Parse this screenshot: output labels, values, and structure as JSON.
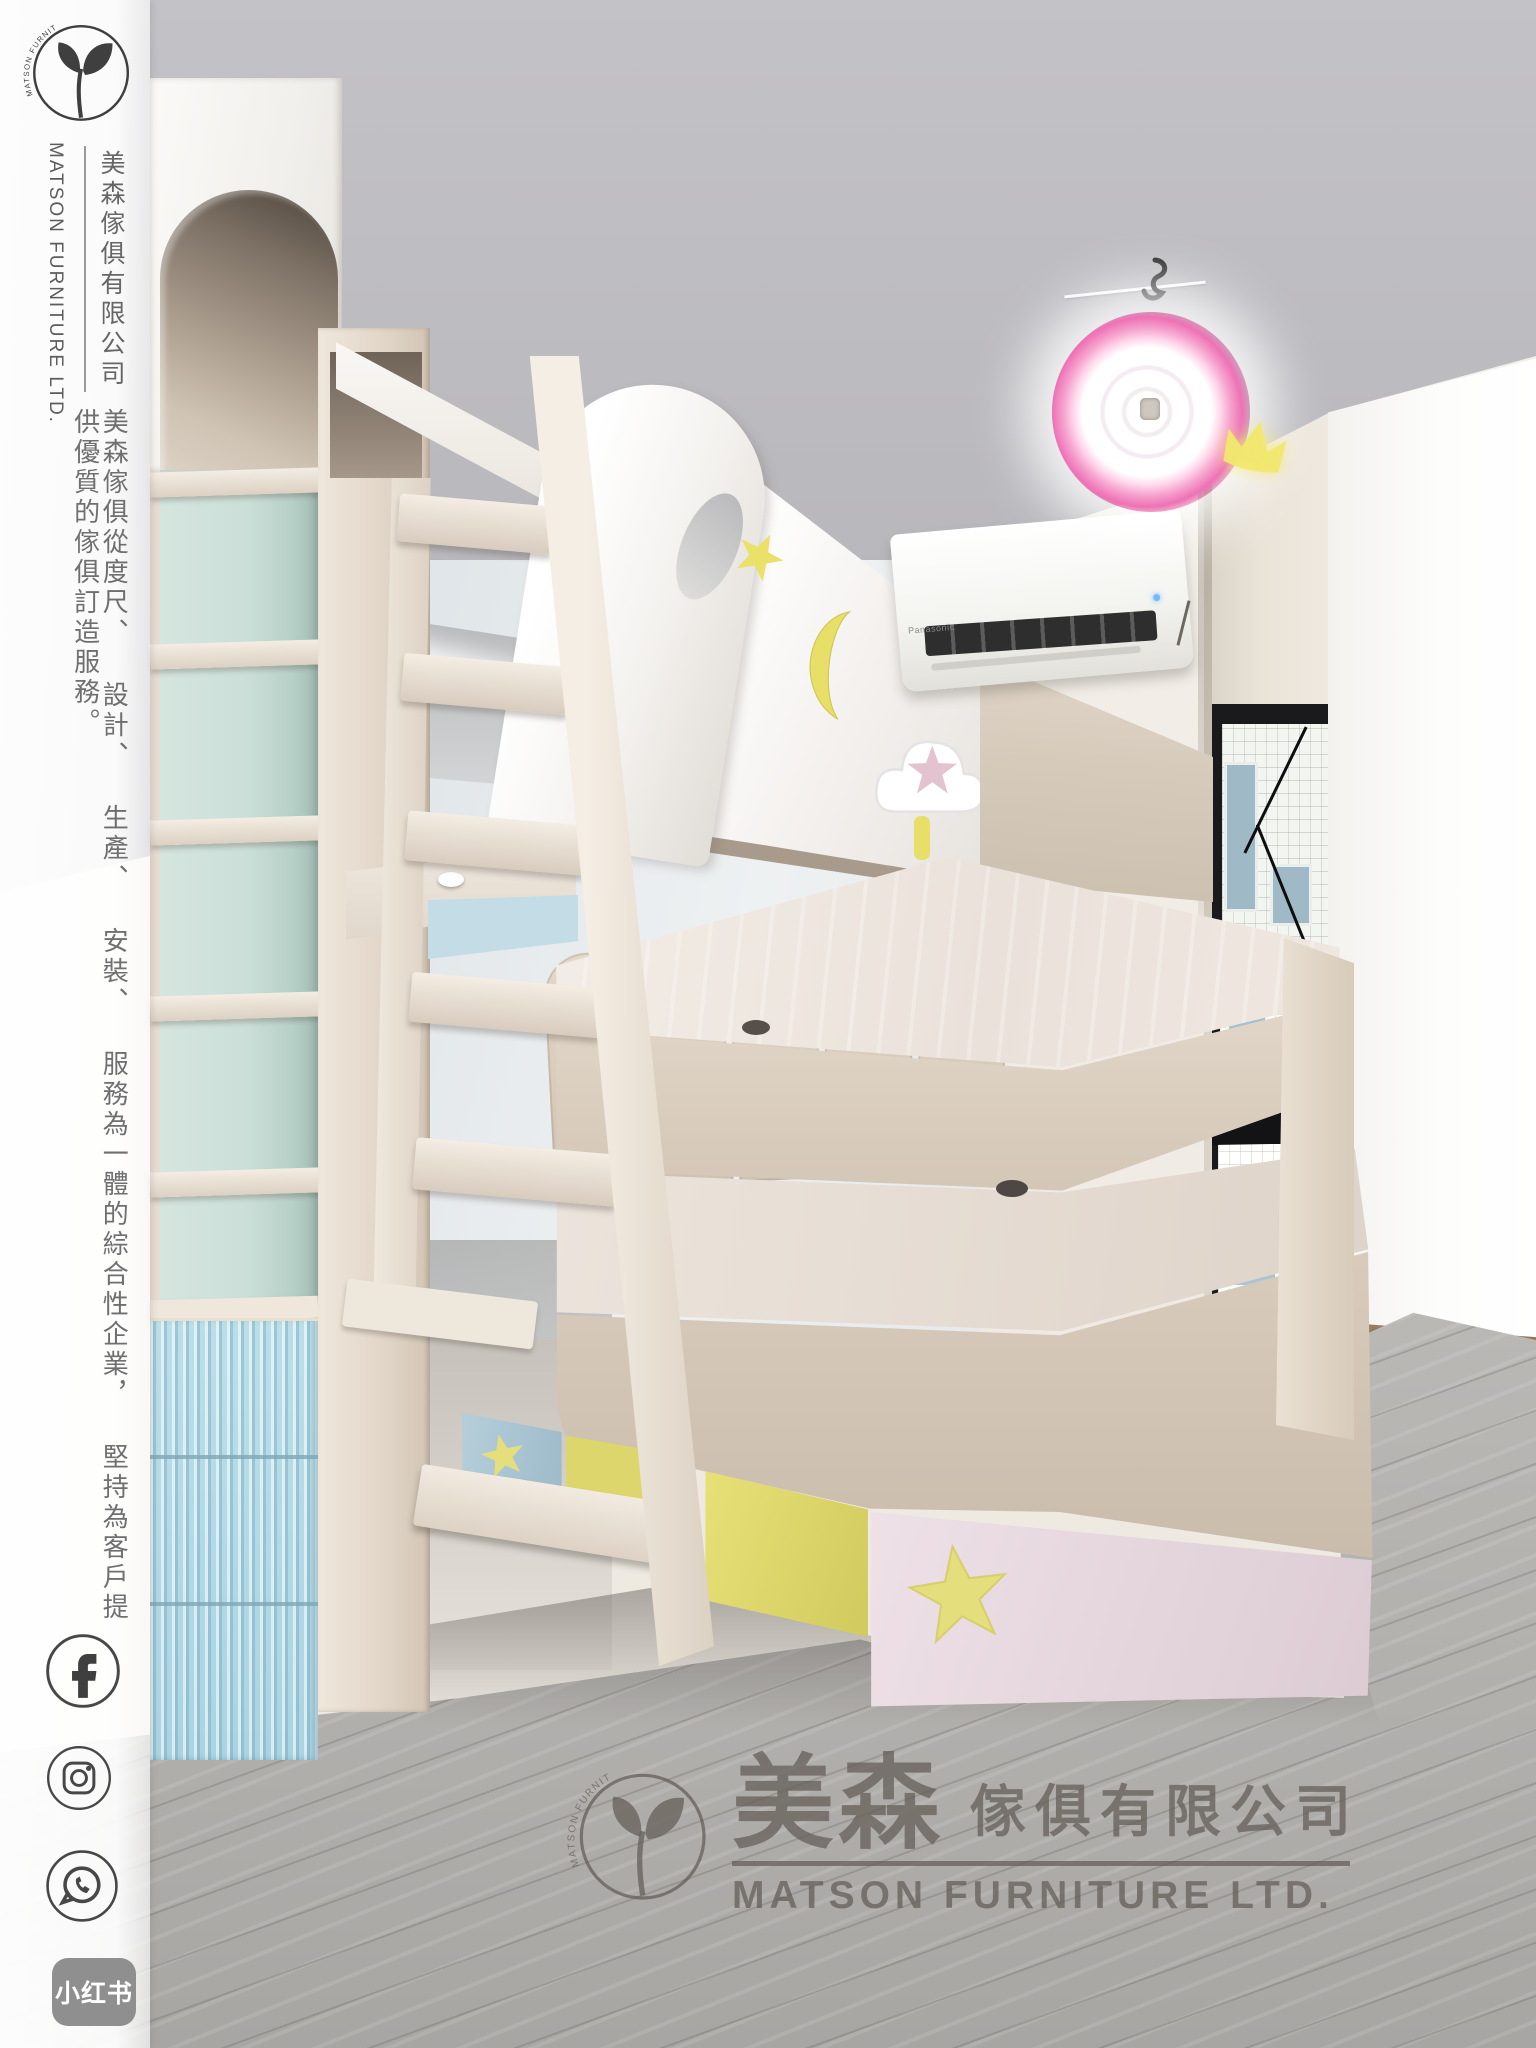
{
  "sidebar": {
    "logo_arc_text": "MATSON FURNITURE",
    "company_en": "MATSON FURNITURE LTD.",
    "company_zh": "美森傢俱有限公司",
    "tagline_zh": "美森傢俱從度尺、 設計、 生產、 安裝、 服務為一體的綜合性企業， 堅持為客戶提供優質的傢俱訂造服務。",
    "social": {
      "facebook": "facebook",
      "instagram": "instagram",
      "whatsapp": "whatsapp",
      "xiaohongshu_label": "小红书"
    }
  },
  "watermark": {
    "logo_arc_text": "MATSON FURNITURE",
    "zh_primary": "美森",
    "zh_secondary": "傢俱有限公司",
    "en": "MATSON FURNITURE LTD."
  },
  "ac_unit": {
    "brand": "Panasonic"
  },
  "scene": {
    "description": "Children's bedroom with custom bunk bed, desk, arched bookshelf and pastel drawers",
    "colors": {
      "brand_ink": "#3f3f3f",
      "sidebar_text": "#6a6a6a",
      "xiaohongshu_badge": "#8f8f8f",
      "watermark_gray": "#625c56",
      "accent_blue": "#aad4e2",
      "accent_yellow": "#ddd76a",
      "accent_pink": "#e6d8de",
      "accent_teal": "#cbdfd8",
      "light_ring_pink": "#ee72b5",
      "floor_gray": "#b3b1ae"
    }
  }
}
